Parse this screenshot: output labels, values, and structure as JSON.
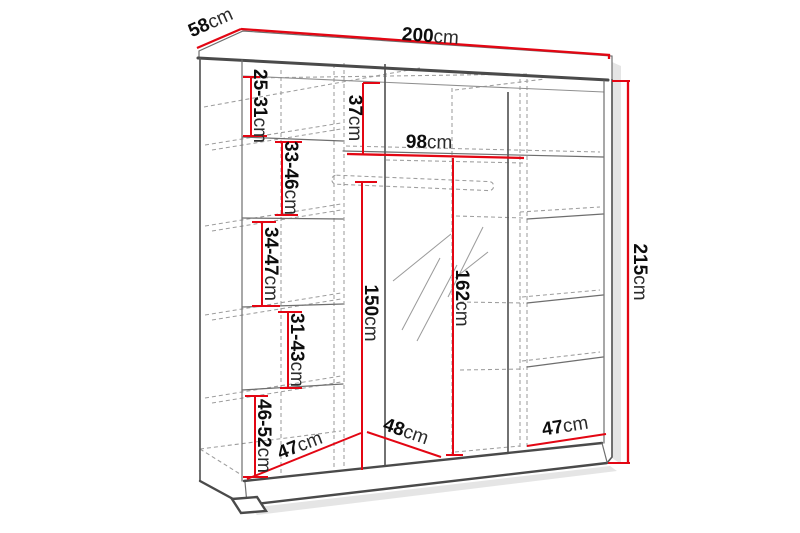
{
  "diagram": {
    "accent_color": "#e30613",
    "line_color": "#4a4a4a",
    "dimensions": {
      "width": {
        "num": "200",
        "unit": "cm"
      },
      "depth": {
        "num": "58",
        "unit": "cm"
      },
      "height": {
        "num": "215",
        "unit": "cm"
      },
      "top_compartment_height": {
        "num": "37",
        "unit": "cm"
      },
      "middle_width": {
        "num": "98",
        "unit": "cm"
      },
      "interior_height": {
        "num": "150",
        "unit": "cm"
      },
      "mirror_door_height": {
        "num": "162",
        "unit": "cm"
      },
      "left_floor_width": {
        "num": "47",
        "unit": "cm"
      },
      "middle_floor_width": {
        "num": "48",
        "unit": "cm"
      },
      "right_floor_width": {
        "num": "47",
        "unit": "cm"
      },
      "left_shelf_gaps": [
        {
          "num": "25-31",
          "unit": "cm"
        },
        {
          "num": "33-46",
          "unit": "cm"
        },
        {
          "num": "34-47",
          "unit": "cm"
        },
        {
          "num": "31-43",
          "unit": "cm"
        },
        {
          "num": "46-52",
          "unit": "cm"
        }
      ]
    }
  }
}
